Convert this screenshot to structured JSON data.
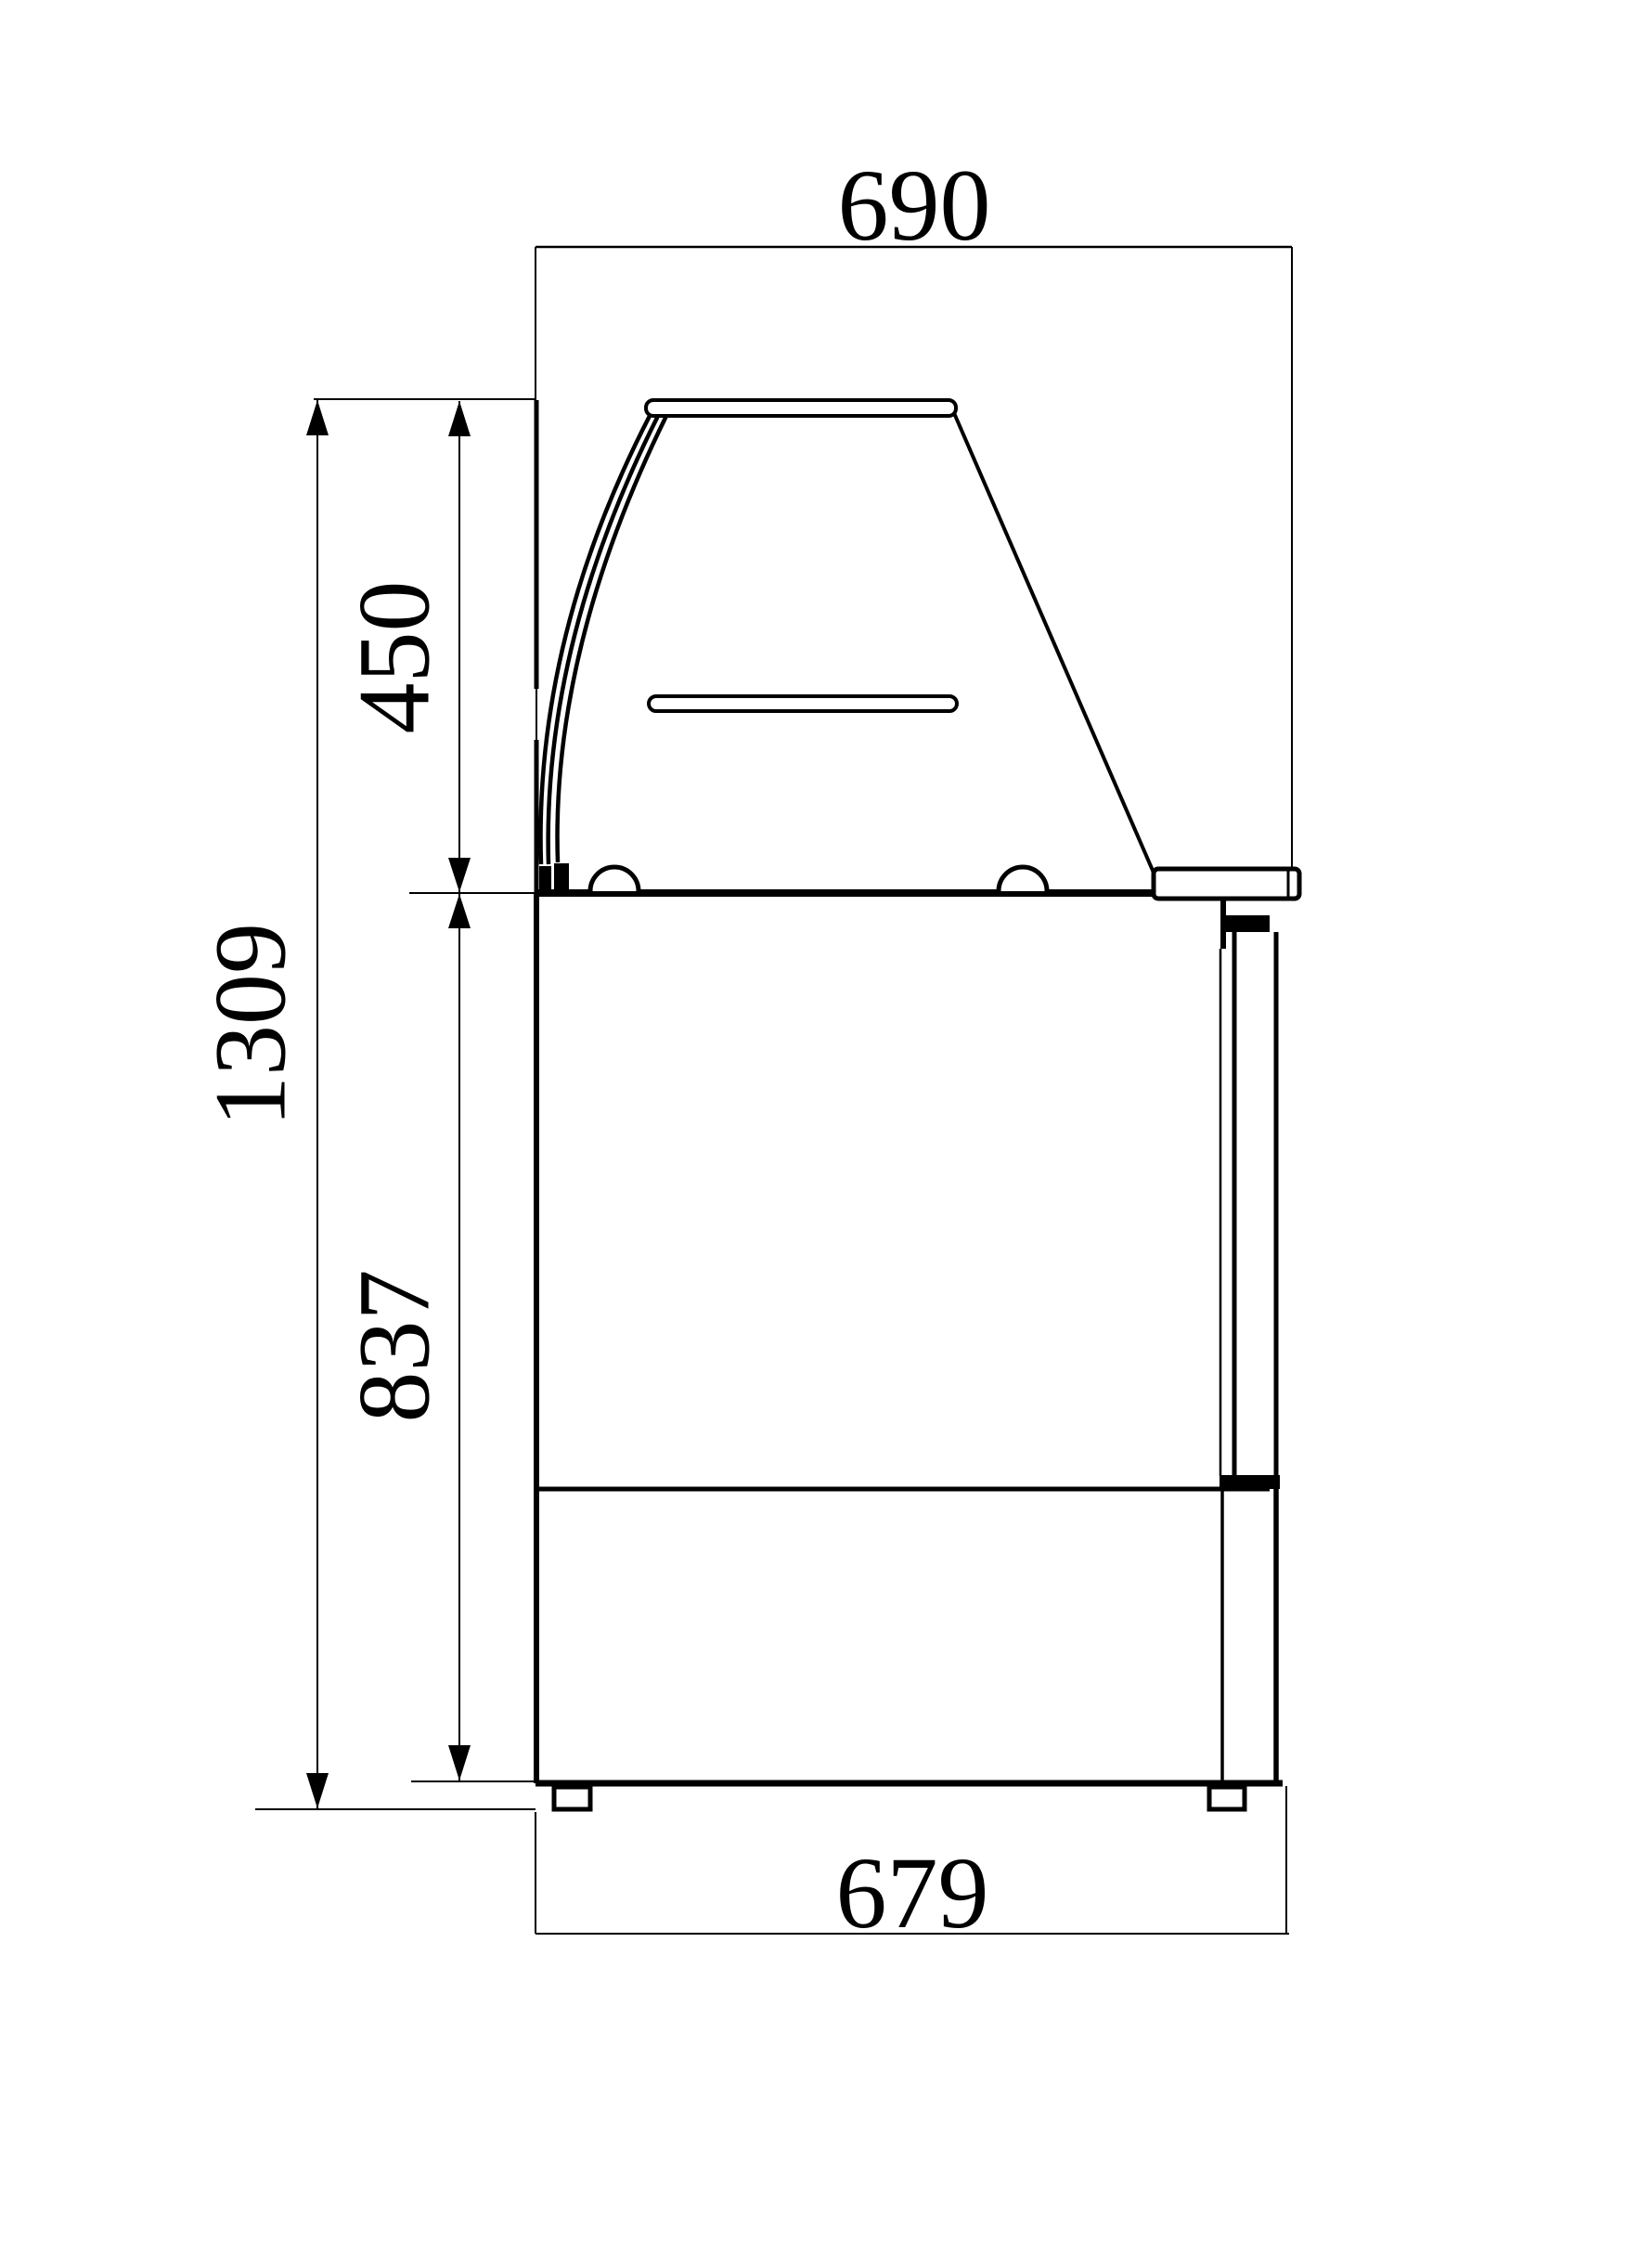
{
  "drawing": {
    "kind": "technical-dimension-drawing",
    "subject": "refrigerated-display-case-side-elevation",
    "background_color": "#ffffff",
    "line_color": "#000000",
    "dimensions": {
      "top_width": "690",
      "glass_section_height": "450",
      "overall_height": "1309",
      "body_height": "837",
      "base_width": "679"
    }
  }
}
